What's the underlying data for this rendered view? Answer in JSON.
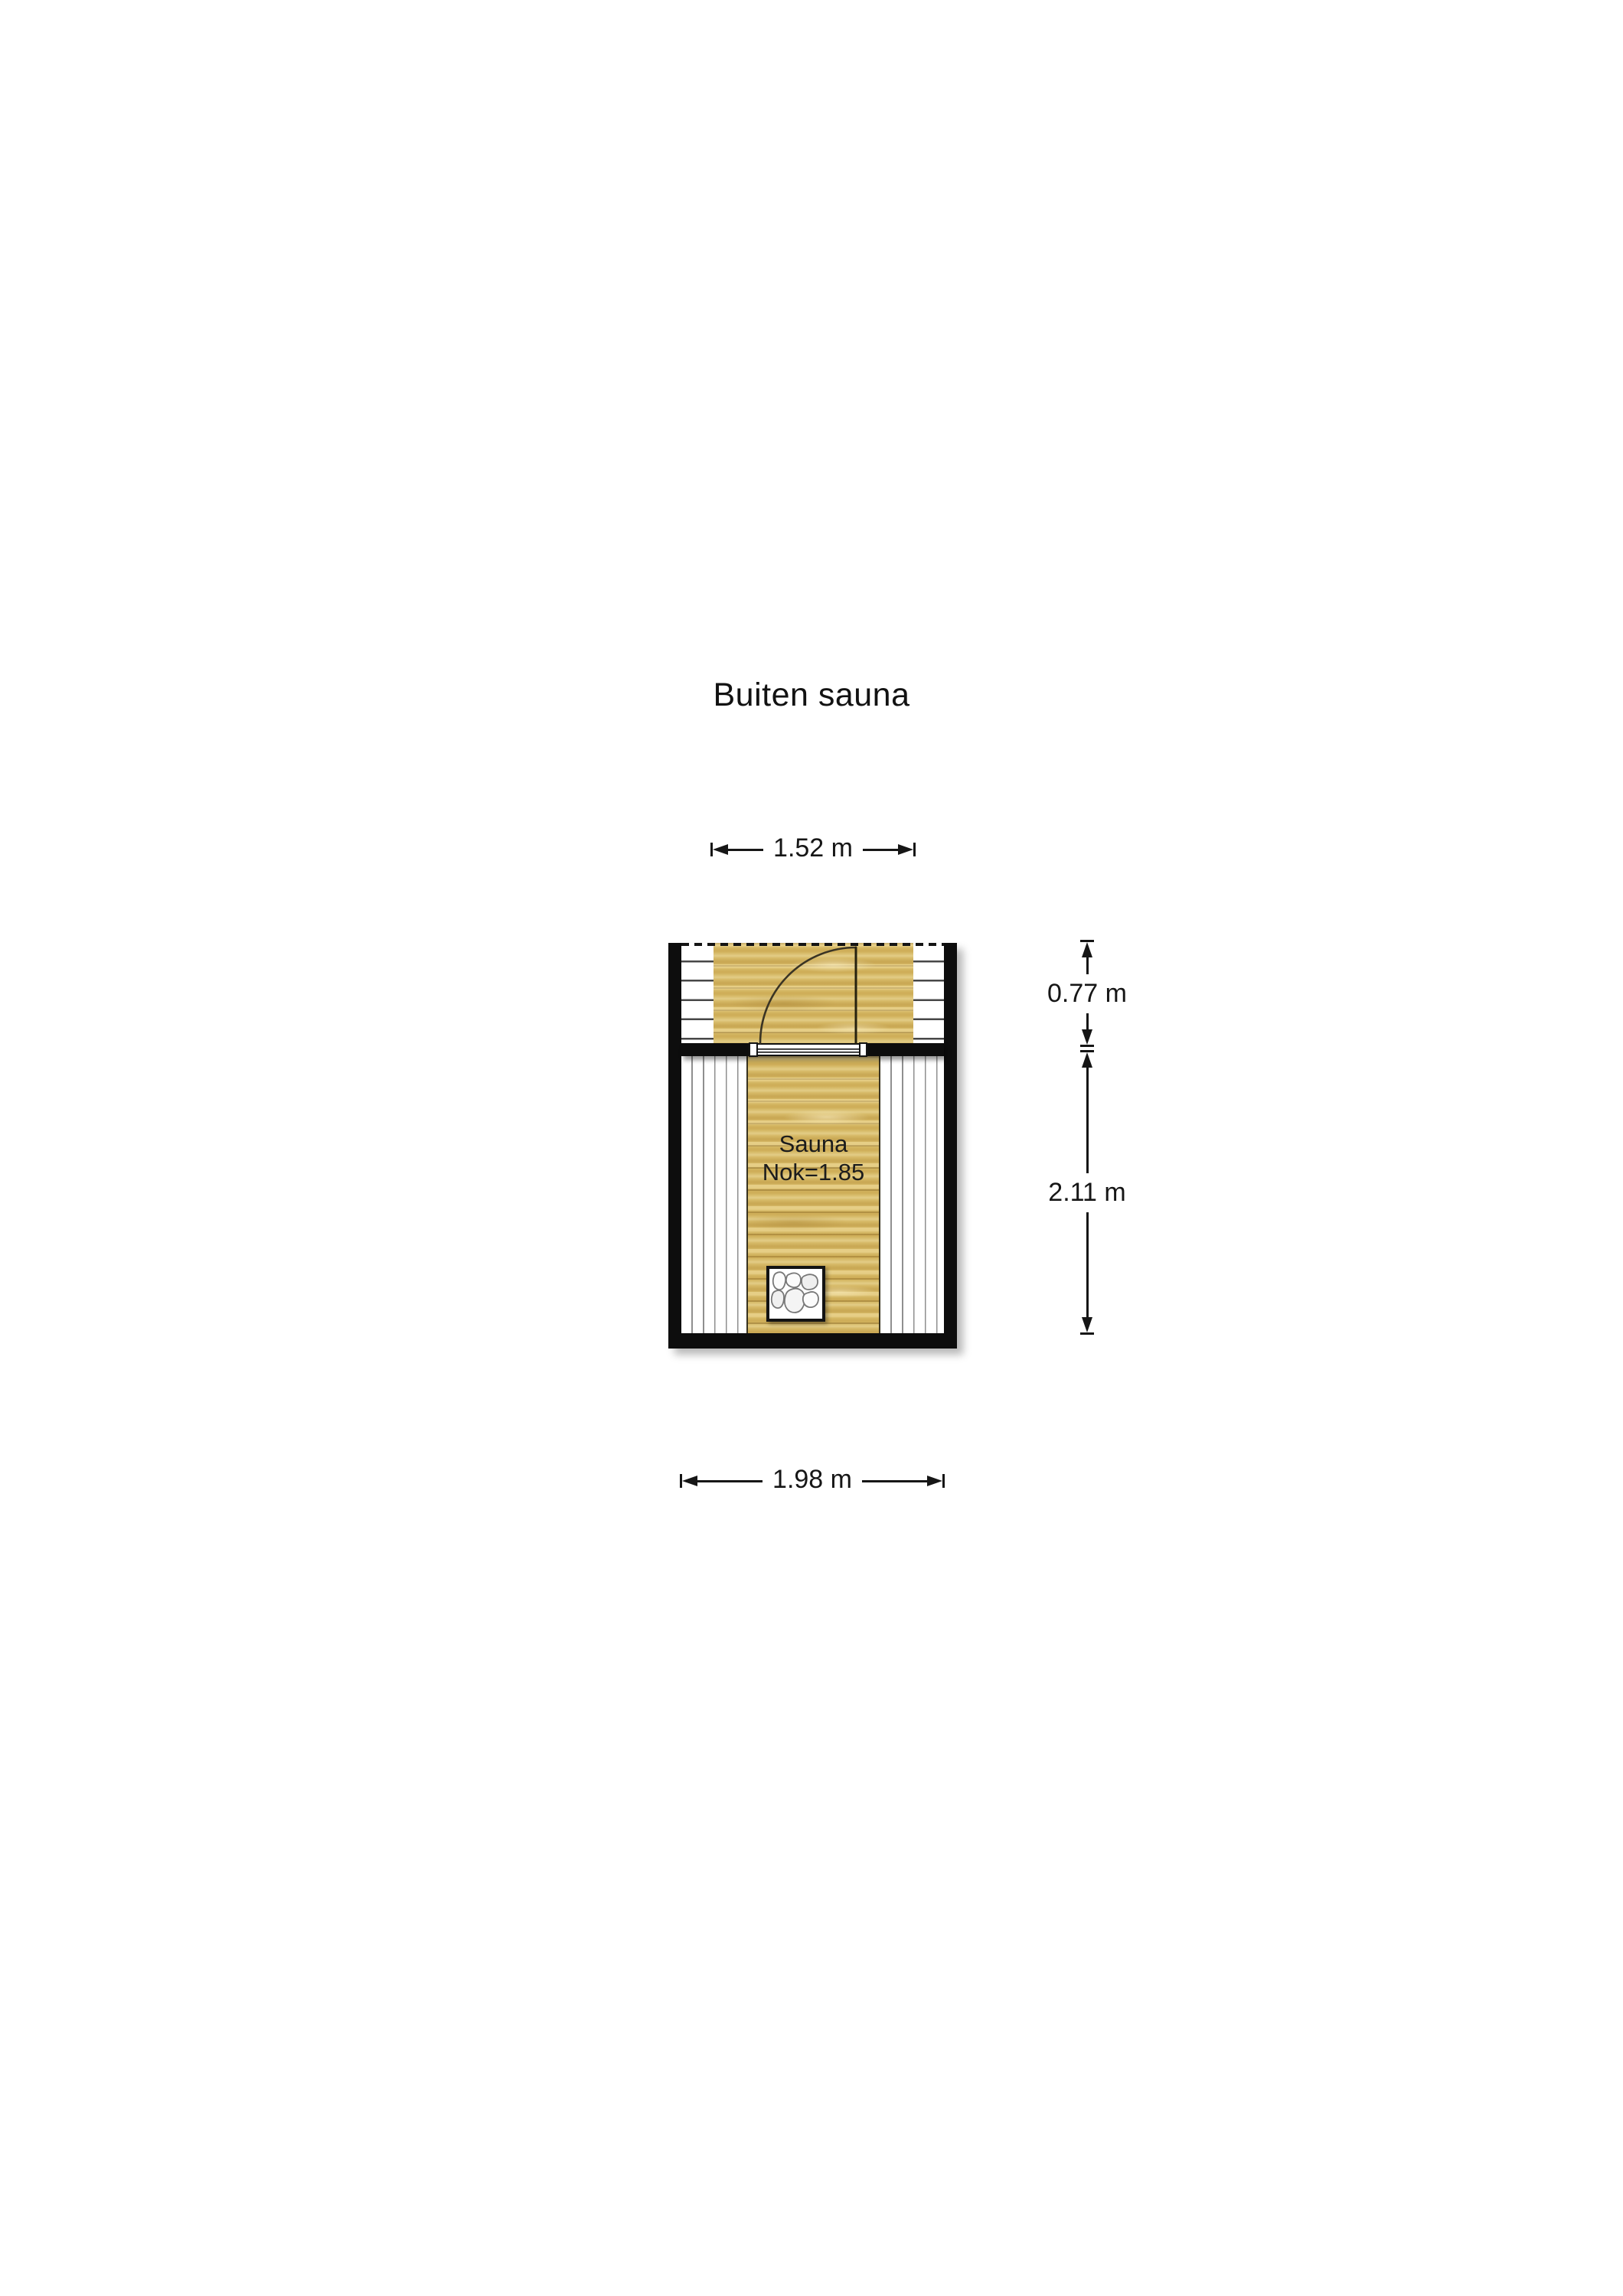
{
  "title": "Buiten sauna",
  "dimensions": {
    "top": "1.52 m",
    "right_upper": "0.77 m",
    "right_lower": "2.11 m",
    "bottom": "1.98 m"
  },
  "room": {
    "label": "Sauna",
    "ridge_height": "Nok=1.85"
  },
  "icons": {
    "heater": "sauna-heater-stones",
    "door": "door-swing-quarter-arc",
    "open_side": "dashed-open-edge"
  },
  "colors": {
    "background": "#ffffff",
    "wall": "#0d0d0d",
    "wood_floor": "#d6b966",
    "bench": "#ffffff",
    "bench_line": "#8f8f8f",
    "dimension_text": "#161616"
  }
}
